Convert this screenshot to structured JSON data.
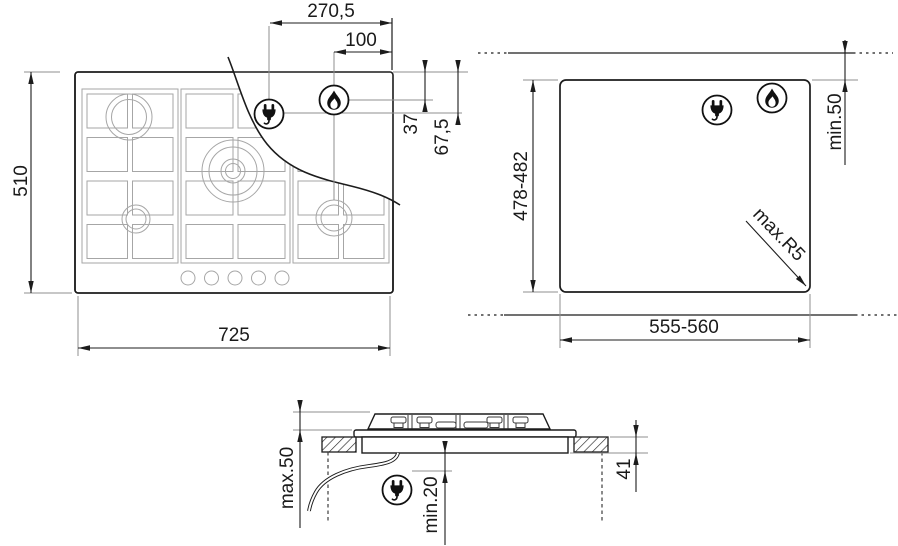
{
  "top_view": {
    "plug_offset_x": "270,5",
    "burner_offset_x": "100",
    "burner_offset_y": "37",
    "plug_offset_y": "67,5",
    "hob_depth": "510",
    "hob_width": "725"
  },
  "cutout_view": {
    "rear_clearance": "min.50",
    "cutout_depth": "478-482",
    "cutout_width": "555-560",
    "corner_radius": "max.R5"
  },
  "section_view": {
    "height_above_worktop": "max.50",
    "clearance_below": "min.20",
    "recess_depth": "41"
  },
  "icons": {
    "plug": "power-plug",
    "flame": "gas-flame"
  },
  "colors": {
    "line": "#1c1c1c",
    "reference_line": "#8f8f8f",
    "grate_line": "#a6a6a6"
  }
}
